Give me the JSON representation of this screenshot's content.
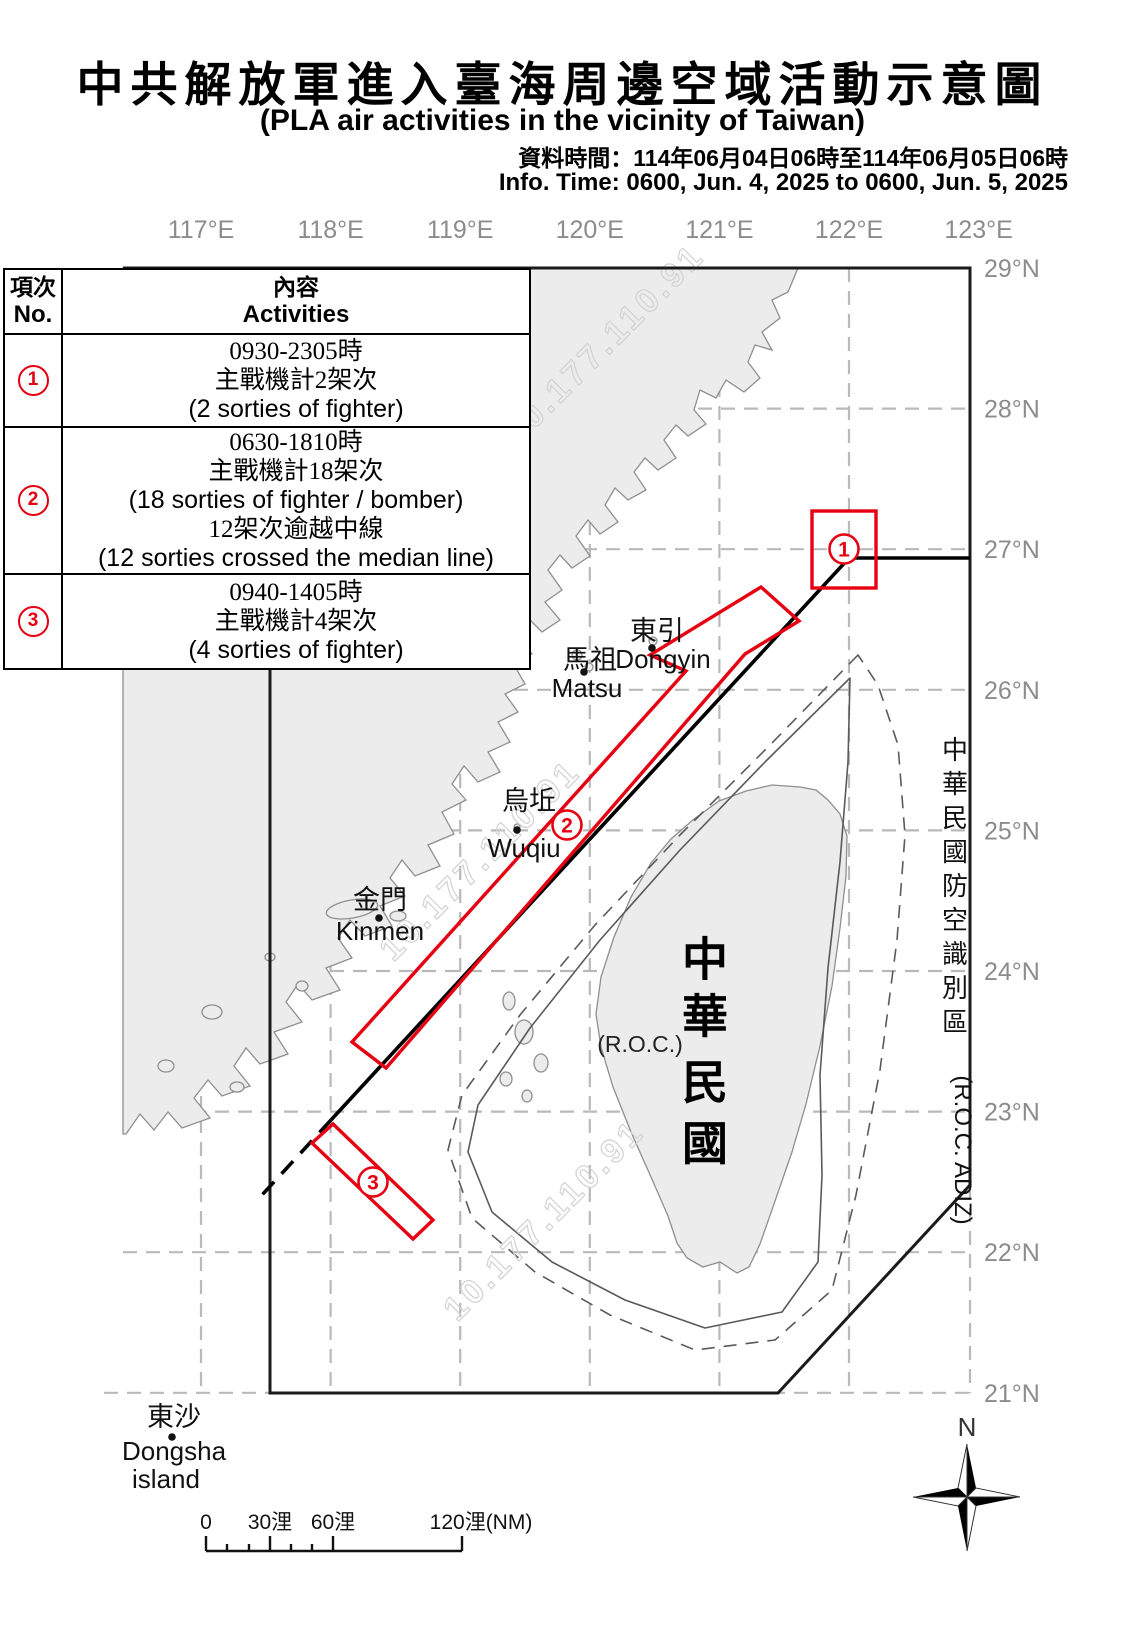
{
  "header": {
    "title_zh": "中共解放軍進入臺海周邊空域活動示意圖",
    "title_en": "(PLA air activities in the vicinity of Taiwan)",
    "info_zh": "資料時間：114年06月04日06時至114年06月05日06時",
    "info_en": "Info. Time: 0600, Jun. 4, 2025 to 0600, Jun. 5, 2025"
  },
  "activities_table": {
    "col1_header_zh": "項次",
    "col1_header_en": "No.",
    "col2_header_zh": "內容",
    "col2_header_en": "Activities",
    "rows": [
      {
        "no": "1",
        "lines": [
          {
            "text": "0930-2305時",
            "lang": "zh"
          },
          {
            "text": "主戰機計2架次",
            "lang": "zh"
          },
          {
            "text": "(2 sorties of fighter)",
            "lang": "en"
          }
        ]
      },
      {
        "no": "2",
        "lines": [
          {
            "text": "0630-1810時",
            "lang": "zh"
          },
          {
            "text": "主戰機計18架次",
            "lang": "zh"
          },
          {
            "text": "(18 sorties of fighter / bomber)",
            "lang": "en"
          },
          {
            "text": "12架次逾越中線",
            "lang": "zh"
          },
          {
            "text": "(12 sorties crossed the median line)",
            "lang": "en"
          }
        ]
      },
      {
        "no": "3",
        "lines": [
          {
            "text": "0940-1405時",
            "lang": "zh"
          },
          {
            "text": "主戰機計4架次",
            "lang": "zh"
          },
          {
            "text": "(4 sorties of fighter)",
            "lang": "en"
          }
        ]
      }
    ]
  },
  "map": {
    "lon_labels": [
      "117°E",
      "118°E",
      "119°E",
      "120°E",
      "121°E",
      "122°E",
      "123°E"
    ],
    "lat_labels": [
      "29°N",
      "28°N",
      "27°N",
      "26°N",
      "25°N",
      "24°N",
      "23°N",
      "22°N",
      "21°N"
    ],
    "places": [
      {
        "id": "dongyin",
        "zh": "東引",
        "en": "Dongyin"
      },
      {
        "id": "matsu",
        "zh": "馬祖",
        "en": "Matsu"
      },
      {
        "id": "wuqiu",
        "zh": "烏坵",
        "en": "Wuqiu"
      },
      {
        "id": "kinmen",
        "zh": "金門",
        "en": "Kinmen"
      },
      {
        "id": "dongsha",
        "zh": "東沙",
        "en": "Dongsha",
        "en2": "island"
      }
    ],
    "taiwan_label_zh": "中華民國",
    "taiwan_label_en": "(R.O.C.)",
    "adiz_label_zh": "中華民國防空識別區",
    "adiz_label_en": "(R.O.C. ADIZ)",
    "markers": [
      {
        "no": "1"
      },
      {
        "no": "2"
      },
      {
        "no": "3"
      }
    ],
    "watermark_text": "10.177.110.91",
    "compass_label": "N",
    "scale_labels": [
      "0",
      "30浬",
      "60浬",
      "120浬(NM)"
    ]
  },
  "colors": {
    "accent_red": "#e60012",
    "land_fill": "#ececec",
    "land_stroke": "#8f8f8f",
    "grid": "#b9b9b9",
    "frame": "#1b1b1b",
    "axis_text": "#8c8c8c",
    "contour": "#5a5a5a"
  }
}
